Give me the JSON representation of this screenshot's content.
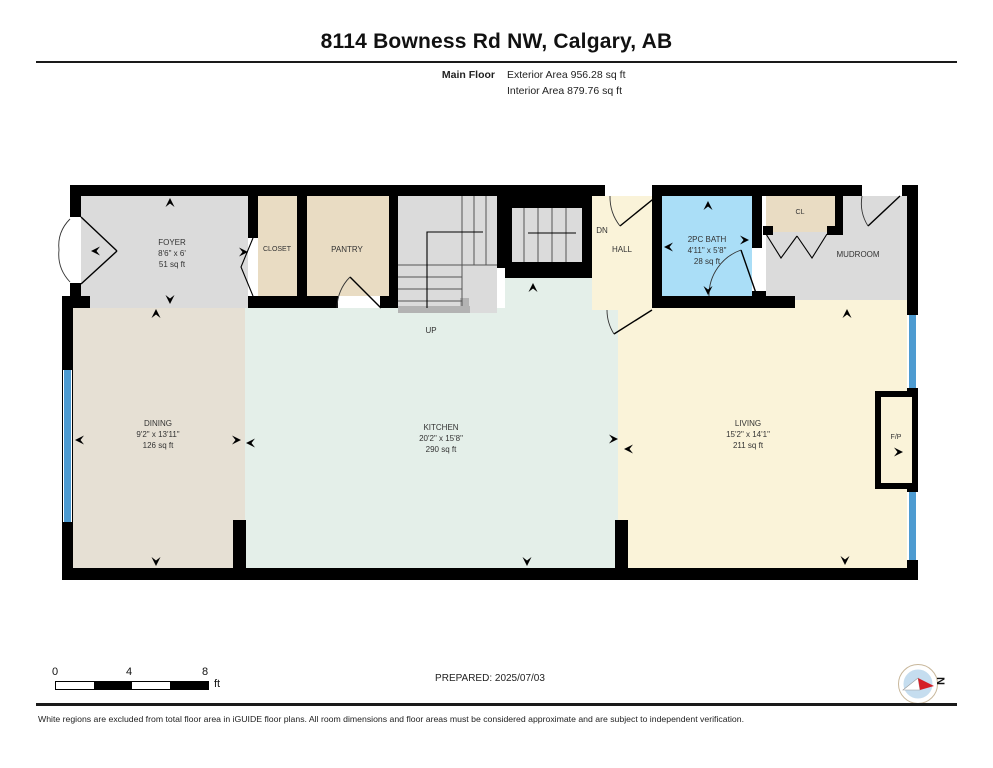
{
  "header": {
    "title": "8114 Bowness Rd NW, Calgary, AB",
    "floor_label": "Main Floor",
    "exterior_area": "Exterior Area 956.28 sq ft",
    "interior_area": "Interior Area 879.76 sq ft"
  },
  "rooms": {
    "foyer": {
      "name": "FOYER",
      "dims": "8'6\" x 6'",
      "area": "51 sq ft"
    },
    "closet": {
      "name": "CLOSET"
    },
    "pantry": {
      "name": "PANTRY"
    },
    "stairs_up": {
      "name": "UP"
    },
    "stairs_dn": {
      "name": "DN"
    },
    "hall": {
      "name": "HALL"
    },
    "bath": {
      "name": "2PC BATH",
      "dims": "4'11\" x 5'8\"",
      "area": "28 sq ft"
    },
    "cl": {
      "name": "CL"
    },
    "mudroom": {
      "name": "MUDROOM"
    },
    "dining": {
      "name": "DINING",
      "dims": "9'2\" x 13'11\"",
      "area": "126 sq ft"
    },
    "kitchen": {
      "name": "KITCHEN",
      "dims": "20'2\" x 15'8\"",
      "area": "290 sq ft"
    },
    "living": {
      "name": "LIVING",
      "dims": "15'2\" x 14'1\"",
      "area": "211 sq ft"
    },
    "fireplace": {
      "name": "F/P"
    }
  },
  "scale_bar": {
    "ticks": [
      "0",
      "4",
      "8"
    ],
    "unit": "ft"
  },
  "prepared": "PREPARED: 2025/07/03",
  "compass": {
    "north_label": "N"
  },
  "footer": {
    "disclaimer": "White regions are excluded from total floor area in iGUIDE floor plans. All room dimensions and floor areas must be considered approximate and are subject to independent verification."
  },
  "colors": {
    "wall": "#000000",
    "gray_room": "#dbdbdb",
    "beige_room": "#e9dcc3",
    "cream_room": "#faf3d9",
    "mint_room": "#e4efe9",
    "tan_room": "#e6e0d4",
    "bath_blue": "#aadef7",
    "window_blue": "#4d9bd1"
  }
}
